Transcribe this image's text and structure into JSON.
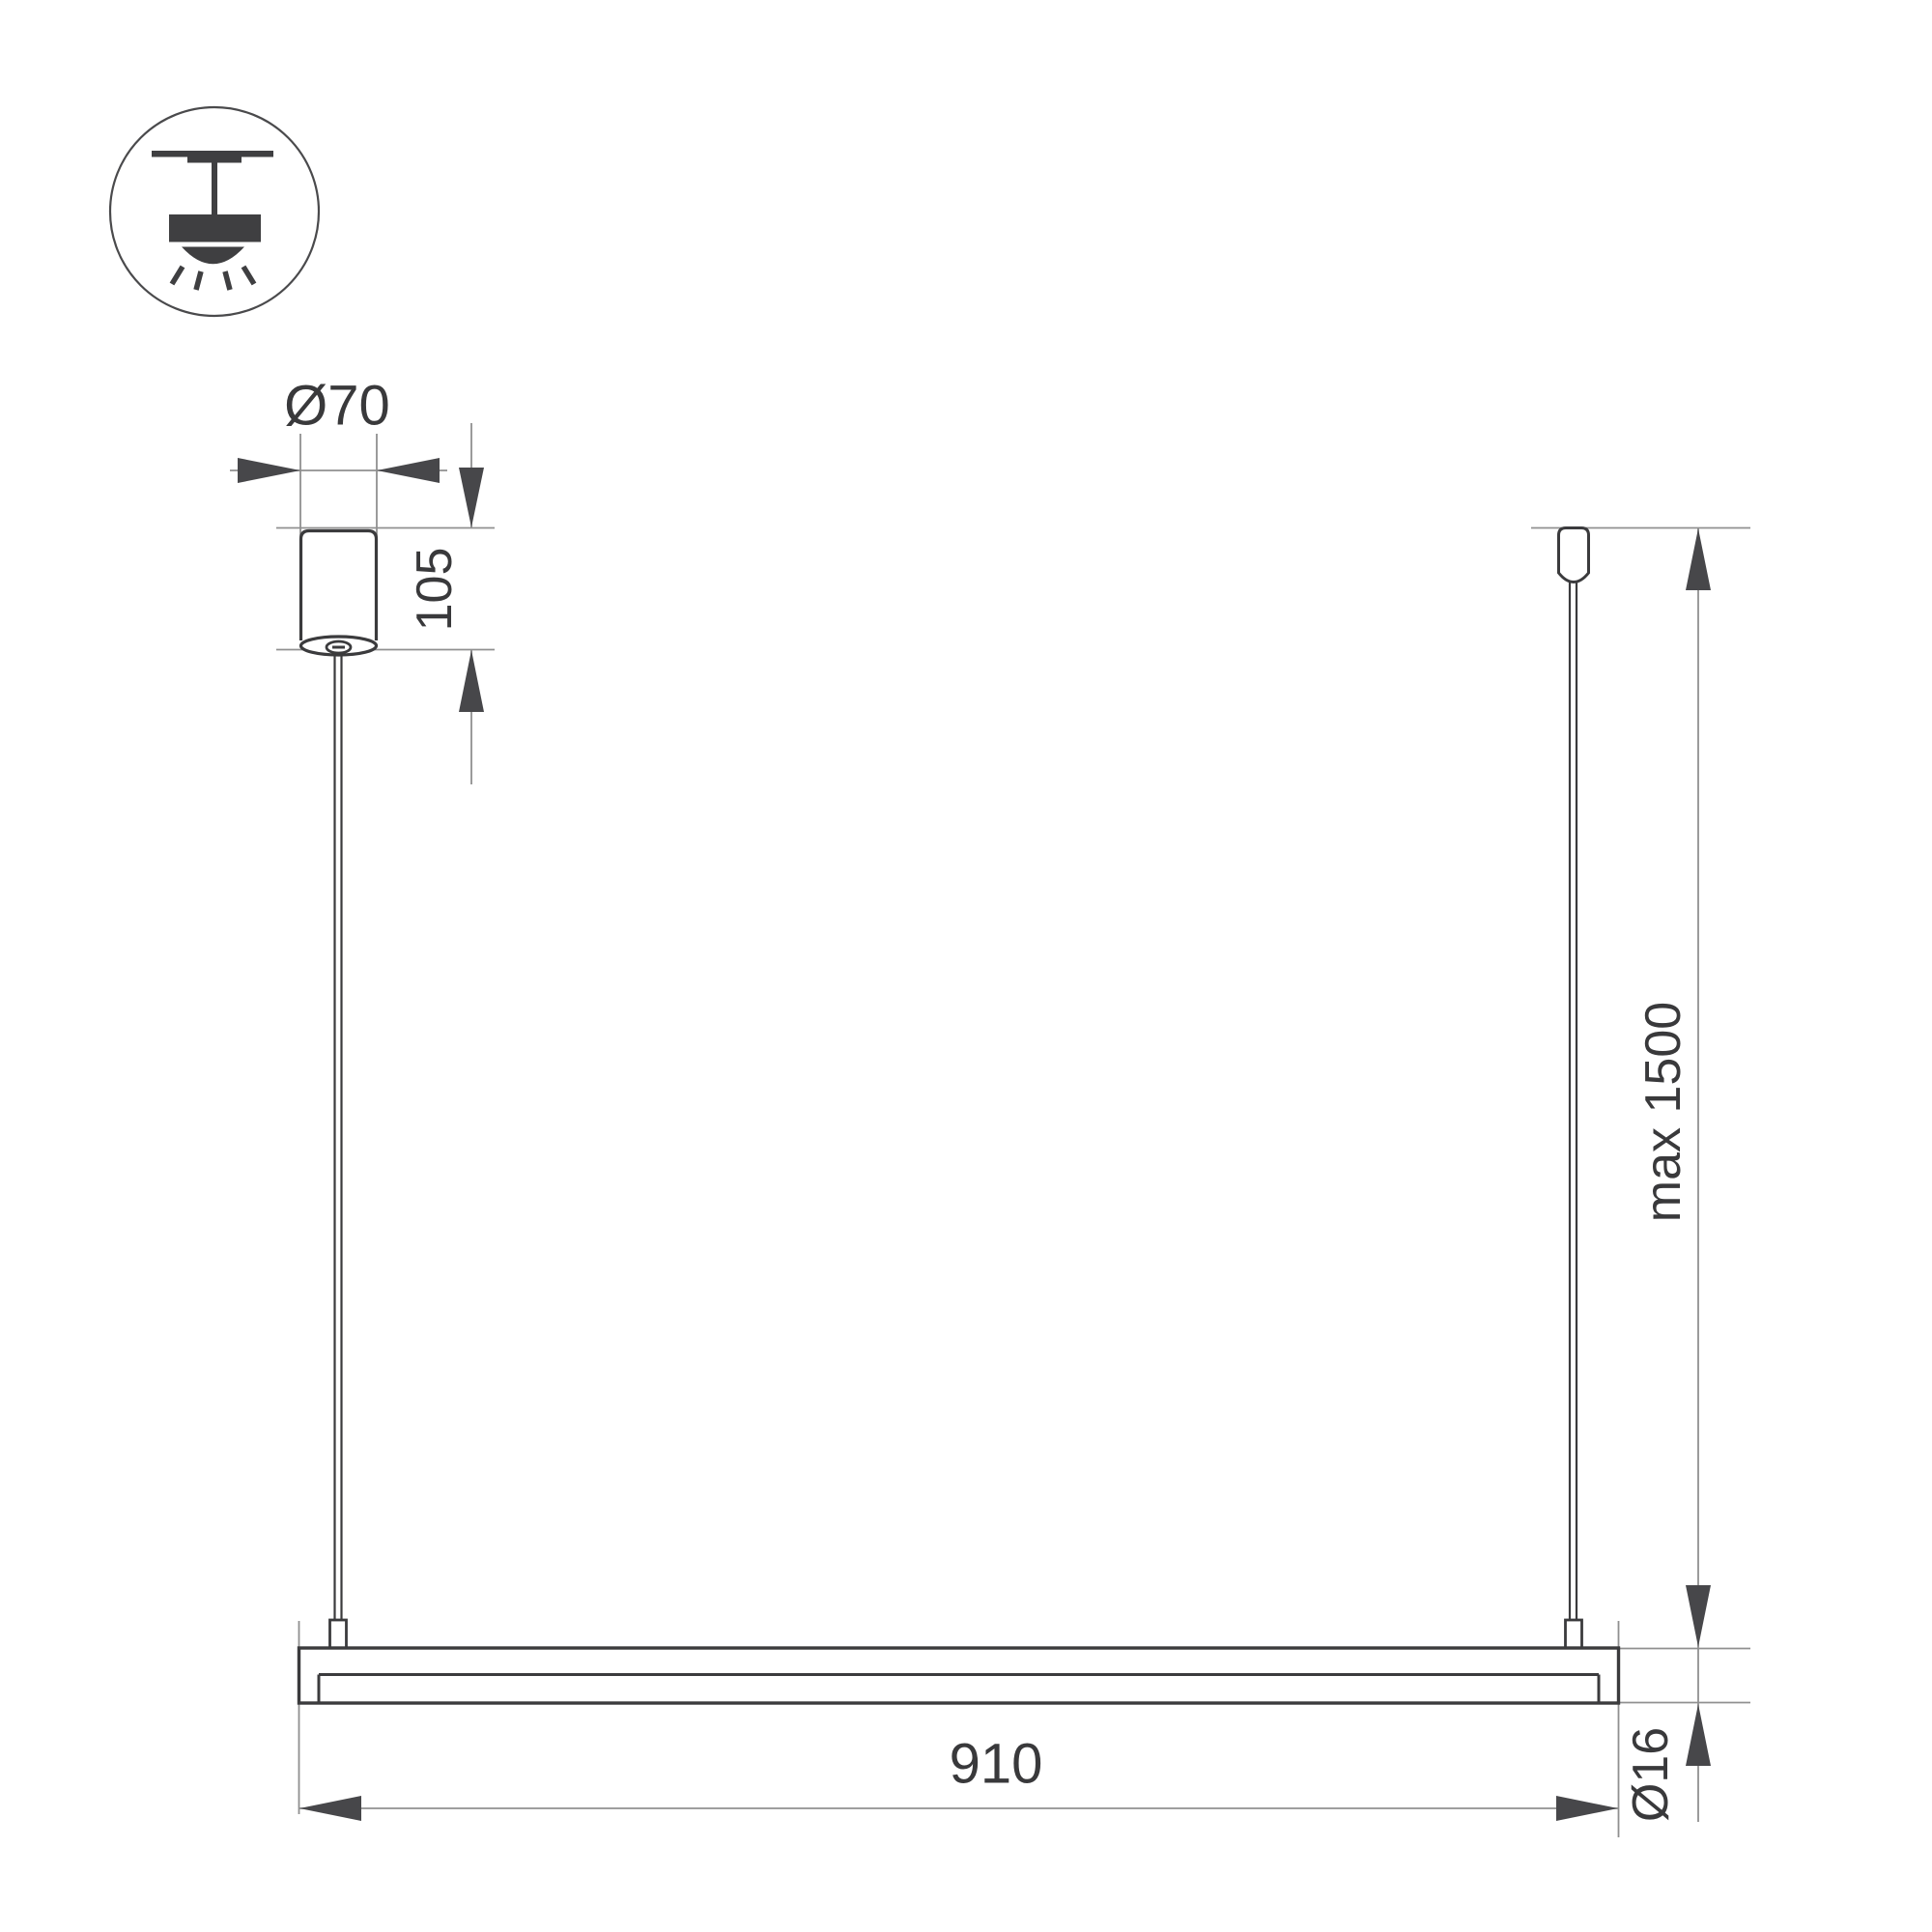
{
  "drawing": {
    "title": "pendant-luminaire-installation-dimension-drawing",
    "labels": {
      "canopy_diameter": "Ø70",
      "canopy_height": "105",
      "max_suspension": "max 1500",
      "fixture_length": "910",
      "tube_diameter": "Ø16"
    },
    "values": {
      "canopy_diameter": 70,
      "canopy_height": 105,
      "max_suspension": 1500,
      "fixture_length": 910,
      "tube_diameter": 16
    }
  },
  "icon": {
    "meaning": "ceiling-mounted pendant light"
  },
  "colors": {
    "background": "#ffffff",
    "object_line": "#3b3b3d",
    "dimension_line": "#909090",
    "arrowhead": "#47474a",
    "text": "#39393b"
  }
}
